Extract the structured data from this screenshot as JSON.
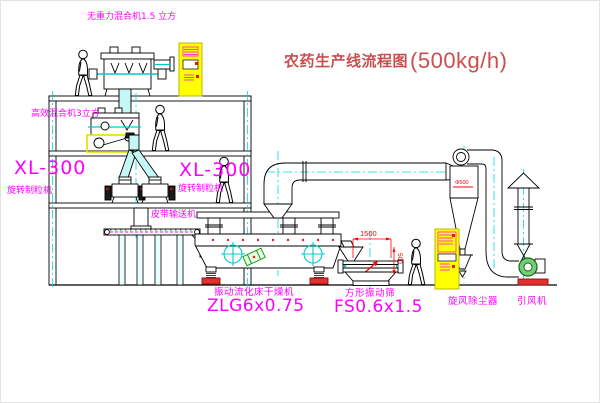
{
  "title": {
    "cn": "农药生产线流程图",
    "capacity": "(500kg/h)"
  },
  "labels": {
    "gravity_mixer": "无重力混合机1.5 立方",
    "high_mixer": "高效混合机3立方",
    "granulator_left_model": "XL-300",
    "granulator_left_name": "旋转制粒机",
    "granulator_right_model": "XL-300",
    "granulator_right_name": "旋转制粒机",
    "belt_conveyor": "皮带输送机",
    "dryer_name": "振动流化床干燥机",
    "dryer_model": "ZLG6x0.75",
    "screen_name": "方形振动筛",
    "screen_model": "FS0.6x1.5",
    "cyclone_name": "旋风除尘器",
    "fan_name": "引风机"
  },
  "dimensions": {
    "screen_length": "1500",
    "screen_height": "500",
    "cyclone_dia": "Φ500"
  },
  "colors": {
    "label_magenta": "#ff00ff",
    "title_red": "#c94f4f",
    "dimension_red": "#ff0000",
    "centerline_cyan": "#00dddd",
    "cabinet_yellow": "#ffff00"
  }
}
